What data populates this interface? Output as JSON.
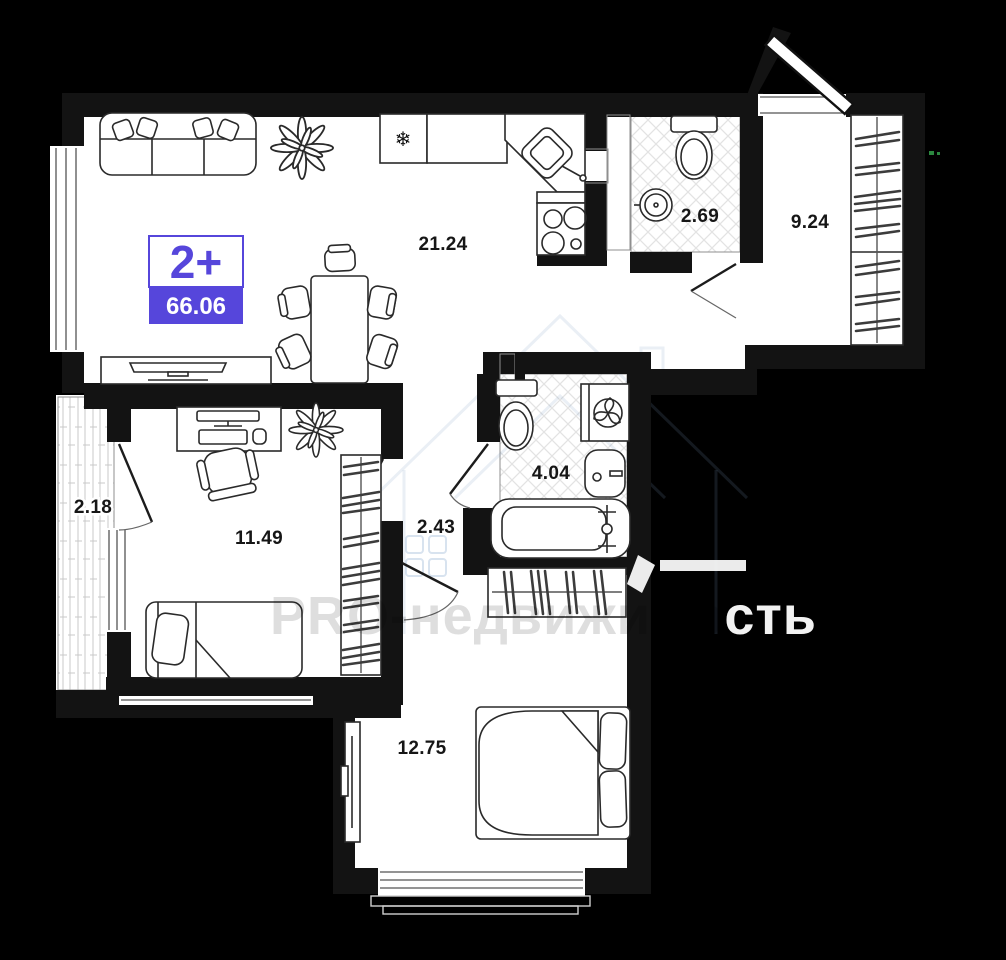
{
  "plan": {
    "badge": {
      "rooms_label": "2+",
      "area_total": "66.06"
    },
    "rooms": {
      "living_kitchen": {
        "area": "21.24"
      },
      "wc_guest": {
        "area": "2.69"
      },
      "entry_hall": {
        "area": "9.24"
      },
      "balcony": {
        "area": "2.18"
      },
      "bedroom_small": {
        "area": "11.49"
      },
      "hallway": {
        "area": "2.43"
      },
      "bathroom": {
        "area": "4.04"
      },
      "bedroom_master": {
        "area": "12.75"
      }
    },
    "icons": {
      "fridge_snowflake": "❄"
    },
    "watermark": {
      "text_muted": "PRO-недвижимо",
      "text_bright": "сть"
    },
    "colors": {
      "accent_purple": "#5646DB",
      "wall_black": "#131313",
      "floor_white": "#FFFFFF",
      "background": "#000000"
    }
  }
}
